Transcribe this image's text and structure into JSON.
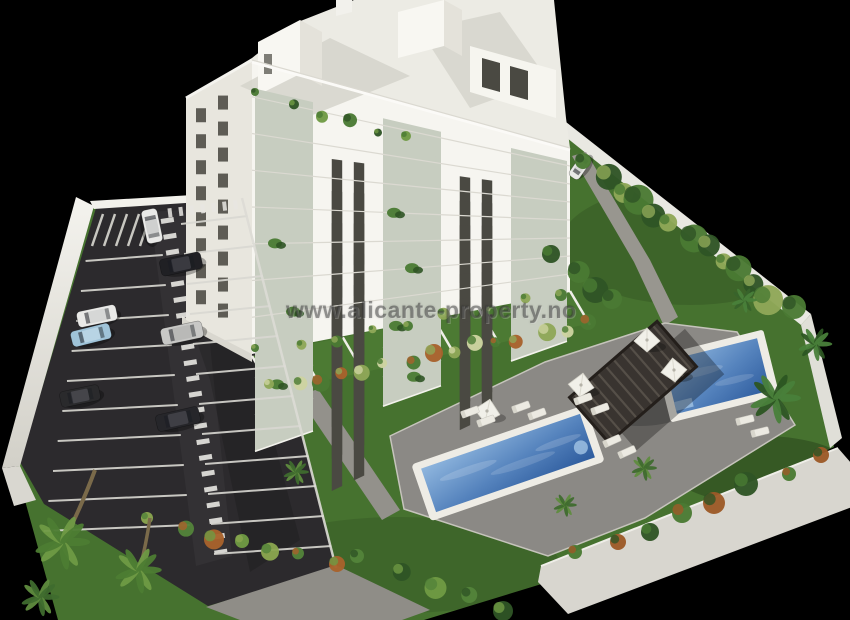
{
  "meta": {
    "kind": "3d-architectural-render",
    "width_px": 850,
    "height_px": 620
  },
  "watermark": {
    "text": "www.alicante-property.no"
  },
  "scene": {
    "building": {
      "floors": 8,
      "facade": "white",
      "balconies": "glass"
    },
    "parking": {
      "cars_visible": 8,
      "surface": "asphalt",
      "walkway": "striped"
    },
    "pools": {
      "count": 2,
      "shape": "rectangular"
    },
    "amenities": [
      "pergola",
      "parasols",
      "sun-loungers",
      "gardens",
      "palm-trees"
    ]
  },
  "palette": {
    "background": "#000000",
    "building_white": "#f6f5f0",
    "building_shade": "#e8e6de",
    "roof_gray": "#d5d3cb",
    "roof_light": "#ecebe4",
    "asphalt": "#2c2a2d",
    "marking_white": "#e8e7e2",
    "lawn_green": "#46722f",
    "garden_green": "#4c7a33",
    "path_gray": "#98968f",
    "deck_gray": "#8b8985",
    "pool_blue_light": "#8fb6de",
    "pool_blue_mid": "#5583bd",
    "pool_blue_deep": "#2e5c9e",
    "pool_border": "#eeece5",
    "pergola_dark": "#393430",
    "wall_white": "#e9e8e2",
    "wall_band": "#d8d6cf",
    "hedge_dark": "#2f5425",
    "hedge_mid": "#4a7a33",
    "hedge_light": "#8fa857",
    "hedge_bloom": "#cdd3a0",
    "accent_orange": "#a8622c",
    "window_dark": "#4a4942",
    "glass_balcony": "#c7cdc0",
    "car_dark": "#202024",
    "car_white": "#e9e9e7",
    "car_blue": "#9fc3d8",
    "car_silver": "#c8c8c6"
  }
}
